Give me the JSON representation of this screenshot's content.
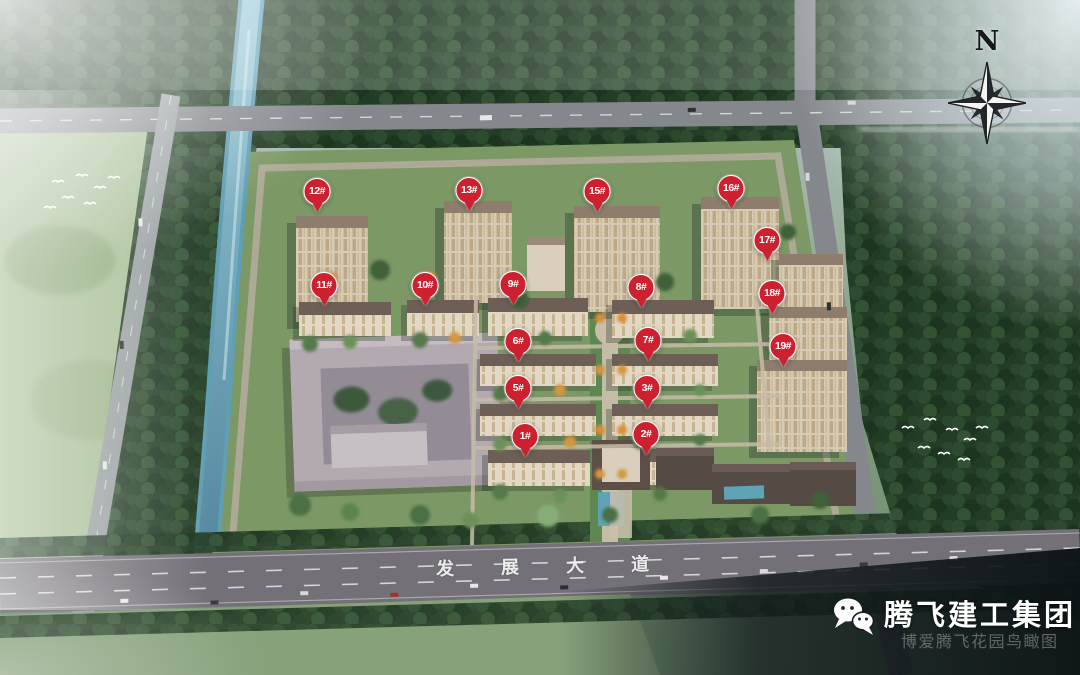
{
  "scene": {
    "title": "residential-masterplan-aerial-rendering",
    "compass": {
      "label": "N"
    },
    "road_label": {
      "text": "发展大道"
    },
    "watermark": {
      "brand": "腾飞建工集团",
      "caption": "博爱腾飞花园鸟瞰图",
      "icon": "wechat-icon"
    },
    "markers": [
      {
        "label": "1#",
        "x": 525,
        "y": 457
      },
      {
        "label": "2#",
        "x": 646,
        "y": 455
      },
      {
        "label": "3#",
        "x": 647,
        "y": 409
      },
      {
        "label": "5#",
        "x": 518,
        "y": 409
      },
      {
        "label": "6#",
        "x": 518,
        "y": 362
      },
      {
        "label": "7#",
        "x": 648,
        "y": 361
      },
      {
        "label": "8#",
        "x": 641,
        "y": 308
      },
      {
        "label": "9#",
        "x": 513,
        "y": 305
      },
      {
        "label": "10#",
        "x": 425,
        "y": 306
      },
      {
        "label": "11#",
        "x": 324,
        "y": 306
      },
      {
        "label": "12#",
        "x": 317,
        "y": 212
      },
      {
        "label": "13#",
        "x": 469,
        "y": 211
      },
      {
        "label": "15#",
        "x": 597,
        "y": 212
      },
      {
        "label": "16#",
        "x": 731,
        "y": 209
      },
      {
        "label": "17#",
        "x": 767,
        "y": 261
      },
      {
        "label": "18#",
        "x": 772,
        "y": 314
      },
      {
        "label": "19#",
        "x": 783,
        "y": 367
      }
    ],
    "colors": {
      "marker_red": "#ce2130",
      "marker_text": "#ffffff",
      "water": "#5f9fb4",
      "forest_green": "#243d26",
      "road_gray": "#737077",
      "brand_text": "#ffffff"
    }
  }
}
